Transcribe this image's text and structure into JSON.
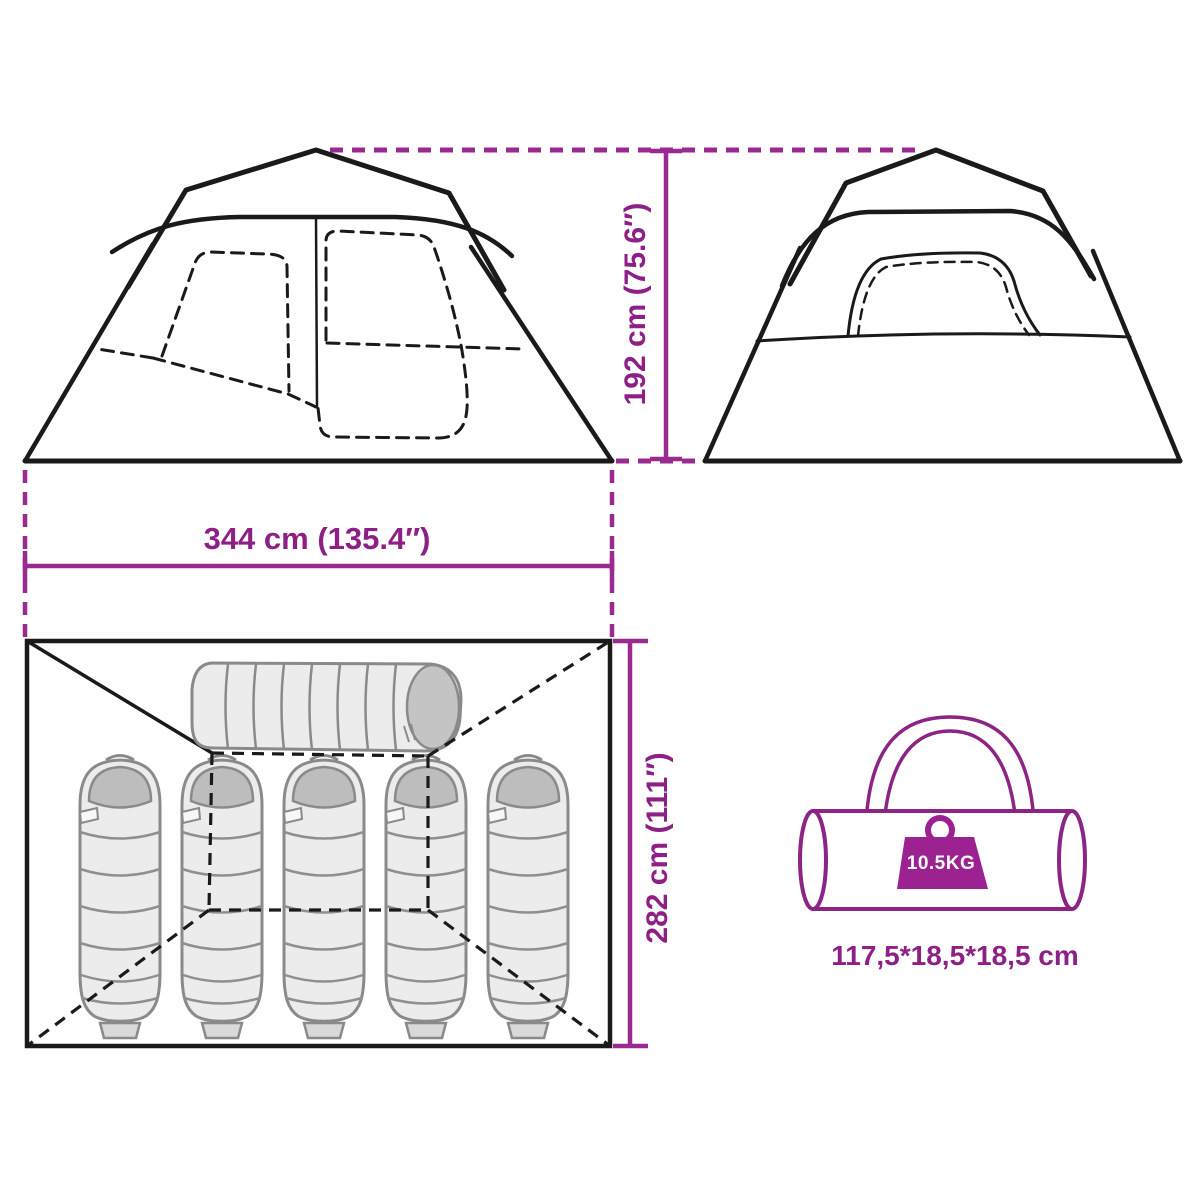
{
  "page": {
    "background": "#ffffff",
    "description_labels_visible": [
      "tent front elevation",
      "tent side elevation",
      "tent floor plan with sleeping bags",
      "carry bag"
    ]
  },
  "colors": {
    "accent_purple": "#8e1f87",
    "construction_dash_purple": "#992a90",
    "weight_fill_purple": "#9c2191",
    "carry_bag_outline": "#8b2484",
    "line_art_black": "#1a1a1a",
    "sleeping_bag_fill": "#ececec",
    "sleeping_bag_hood": "#bdbdbd",
    "sleeping_bag_outline": "#8a8a8a"
  },
  "dimensions": {
    "height_label": "192 cm (75.6″)",
    "width_label": "344 cm (135.4″)",
    "depth_label": "282 cm (111″)"
  },
  "carry_bag": {
    "weight_label": "10.5KG",
    "size_label": "117,5*18,5*18,5 cm"
  },
  "icons": {
    "weight_icon": "kettlebell-weight-icon",
    "carry_bag_icon": "duffel-bag-icon",
    "sleeping_bag_icon": "mummy-sleeping-bag-icon"
  },
  "counts": {
    "vertical_sleeping_bags": 5,
    "horizontal_sleeping_bags": 1
  }
}
